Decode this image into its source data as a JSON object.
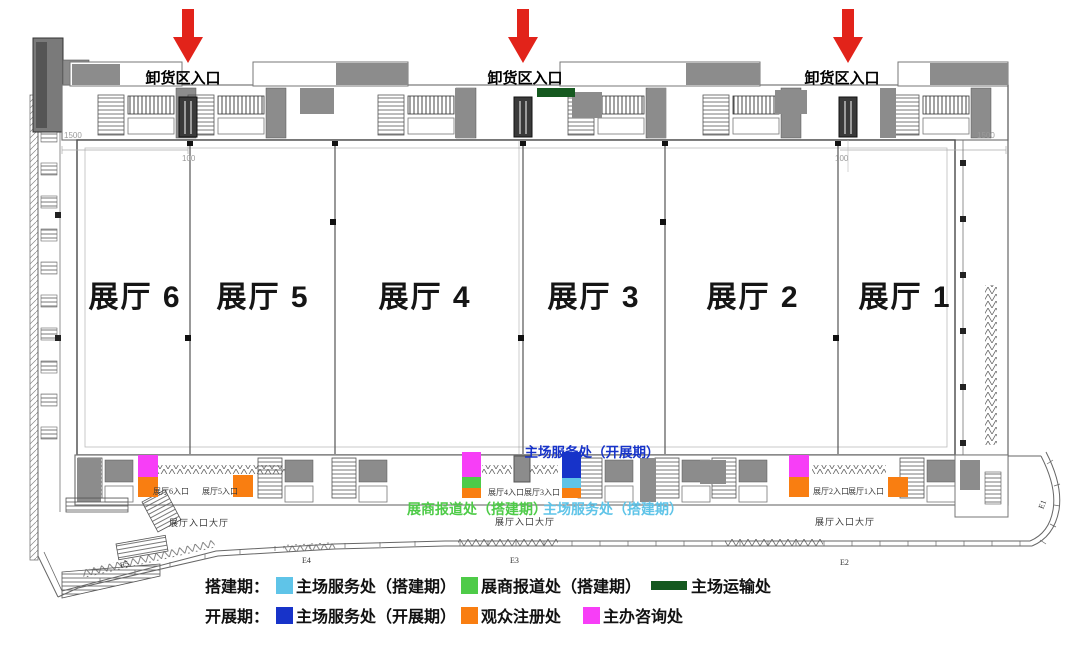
{
  "colors": {
    "arrow_red": "#e2231a",
    "setup_service": "#5fc4e8",
    "exhibitor_checkin": "#4ecb48",
    "transport": "#15591f",
    "show_service": "#1733c9",
    "visitor_registration": "#f97e11",
    "organizer_info": "#f73ef7"
  },
  "unloading_entrances": [
    {
      "label": "卸货区入口"
    },
    {
      "label": "卸货区入口"
    },
    {
      "label": "卸货区入口"
    }
  ],
  "halls": [
    {
      "label": "展厅 6"
    },
    {
      "label": "展厅 5"
    },
    {
      "label": "展厅 4"
    },
    {
      "label": "展厅 3"
    },
    {
      "label": "展厅 2"
    },
    {
      "label": "展厅 1"
    }
  ],
  "annotations": {
    "show_service": "主场服务处（开展期）",
    "exhibitor_checkin": "展商报道处（搭建期）",
    "setup_service": "主场服务处（搭建期）"
  },
  "hall_entrances": [
    {
      "label": "展厅6入口"
    },
    {
      "label": "展厅5入口"
    },
    {
      "label": "展厅4入口"
    },
    {
      "label": "展厅3入口"
    },
    {
      "label": "展厅2入口"
    },
    {
      "label": "展厅1入口"
    }
  ],
  "lobby_labels": [
    {
      "label": "展厅入口大厅"
    },
    {
      "label": "展厅入口大厅"
    },
    {
      "label": "展厅入口大厅"
    }
  ],
  "gate_labels": [
    {
      "label": "E5"
    },
    {
      "label": "E4"
    },
    {
      "label": "E3"
    },
    {
      "label": "E2"
    },
    {
      "label": "E1"
    }
  ],
  "dimension_labels": [
    {
      "label": "1500"
    },
    {
      "label": "100"
    },
    {
      "label": "100"
    },
    {
      "label": "1500"
    }
  ],
  "legend": {
    "rows": [
      {
        "period": "搭建期：",
        "items": [
          {
            "label": "主场服务处（搭建期）",
            "color": "setup_service",
            "shape": "square"
          },
          {
            "label": "展商报道处（搭建期）",
            "color": "exhibitor_checkin",
            "shape": "square"
          },
          {
            "label": "主场运输处",
            "color": "transport",
            "shape": "bar"
          }
        ]
      },
      {
        "period": "开展期：",
        "items": [
          {
            "label": "主场服务处（开展期）",
            "color": "show_service",
            "shape": "square"
          },
          {
            "label": "观众注册处",
            "color": "visitor_registration",
            "shape": "square"
          },
          {
            "label": "主办咨询处",
            "color": "organizer_info",
            "shape": "square"
          }
        ]
      }
    ]
  },
  "map_markers": [
    {
      "id": "hall6-organizer-info",
      "color": "organizer_info"
    },
    {
      "id": "hall6-visitor-registration",
      "color": "visitor_registration"
    },
    {
      "id": "hall5-visitor-registration",
      "color": "visitor_registration"
    },
    {
      "id": "hall4-organizer-info",
      "color": "organizer_info"
    },
    {
      "id": "hall4-exhibitor-checkin",
      "color": "exhibitor_checkin"
    },
    {
      "id": "hall4-visitor-registration",
      "color": "visitor_registration"
    },
    {
      "id": "hall3-show-service",
      "color": "show_service"
    },
    {
      "id": "hall3-setup-service",
      "color": "setup_service"
    },
    {
      "id": "hall3-visitor-registration",
      "color": "visitor_registration"
    },
    {
      "id": "hall2-organizer-info",
      "color": "organizer_info"
    },
    {
      "id": "hall2-visitor-registration",
      "color": "visitor_registration"
    },
    {
      "id": "hall1-visitor-registration",
      "color": "visitor_registration"
    },
    {
      "id": "transport-office-bar",
      "color": "transport"
    }
  ]
}
